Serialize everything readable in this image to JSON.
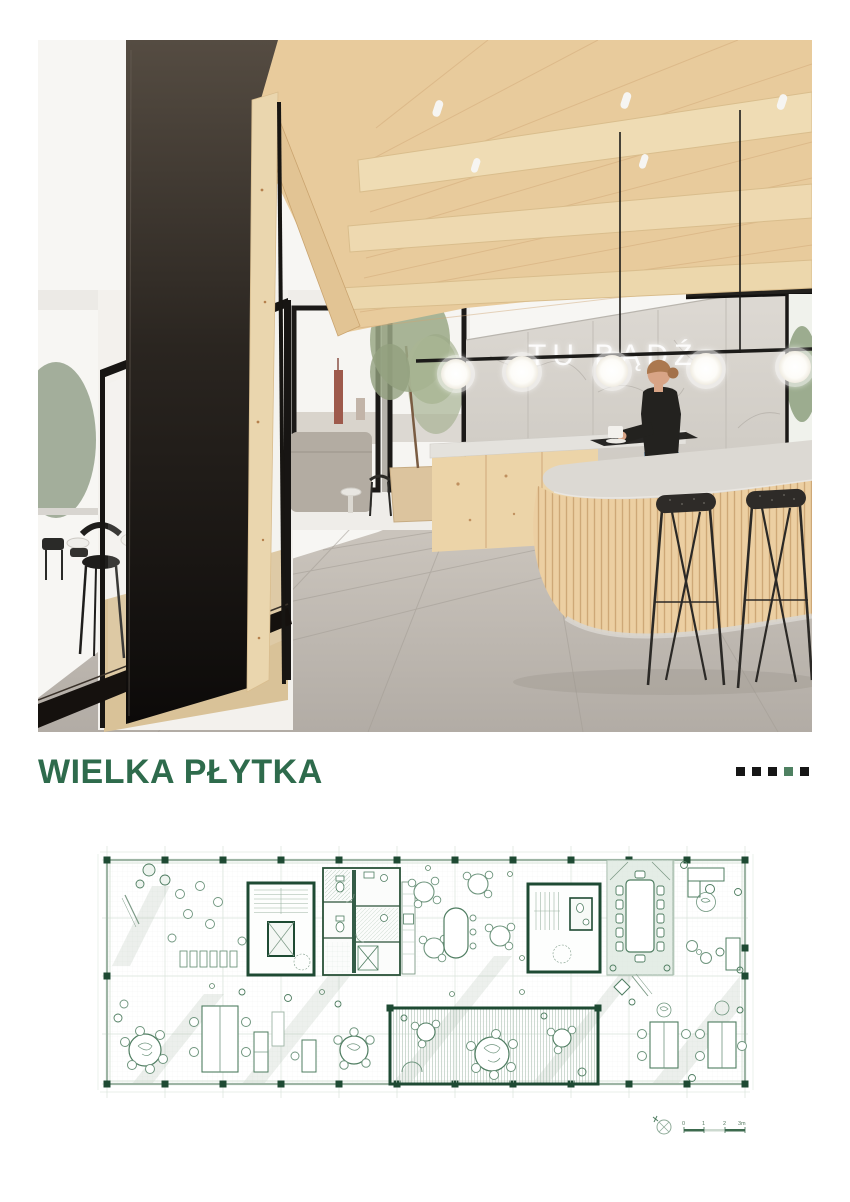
{
  "page": {
    "background": "#ffffff"
  },
  "hero": {
    "neon_sign_text": "TU BĄDŹ",
    "neon_color": "#ffffff"
  },
  "brand": {
    "logo_text": "WIELKA PŁYTKA",
    "logo_color": "#2e6b4c"
  },
  "deco_squares": [
    {
      "color": "#161616"
    },
    {
      "color": "#161616"
    },
    {
      "color": "#161616"
    },
    {
      "color": "#4e8061"
    },
    {
      "color": "#161616"
    }
  ],
  "floor_plan": {
    "primary_green": "#1e4a33",
    "line_green": "#7d9a87",
    "tint_green": "#e4ede6",
    "scalebar": {
      "labels": [
        "0",
        "1",
        "2",
        "3m"
      ]
    }
  }
}
